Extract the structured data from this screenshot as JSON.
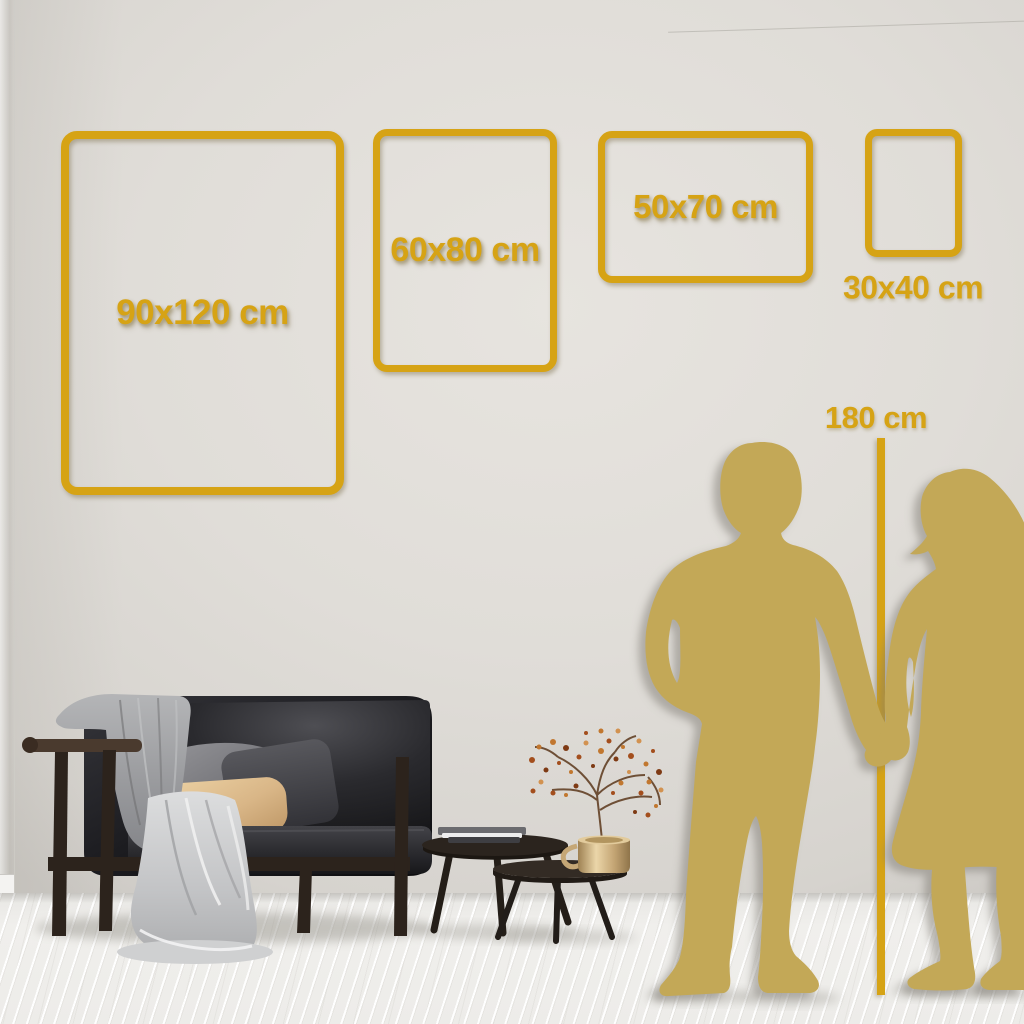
{
  "frames": [
    {
      "id": "90x120",
      "label": "90x120 cm",
      "orientation": "portrait"
    },
    {
      "id": "60x80",
      "label": "60x80 cm",
      "orientation": "portrait"
    },
    {
      "id": "50x70",
      "label": "50x70 cm",
      "orientation": "landscape"
    },
    {
      "id": "30x40",
      "label": "30x40 cm",
      "orientation": "portrait"
    }
  ],
  "height_reference": {
    "label": "180 cm"
  },
  "colors": {
    "accent_gold": "#D6A315",
    "silhouette_gold": "#C3A857",
    "wall": "#E0DDD8",
    "floor": "#F0EFEC"
  },
  "objects": [
    "man-silhouette",
    "woman-silhouette",
    "height-ruler-line",
    "sofa",
    "throw-blanket",
    "seat-drape",
    "back-cushion",
    "dark-pillow",
    "beige-pillow",
    "nesting-coffee-tables",
    "books",
    "brass-vase",
    "dried-flower-branch"
  ]
}
